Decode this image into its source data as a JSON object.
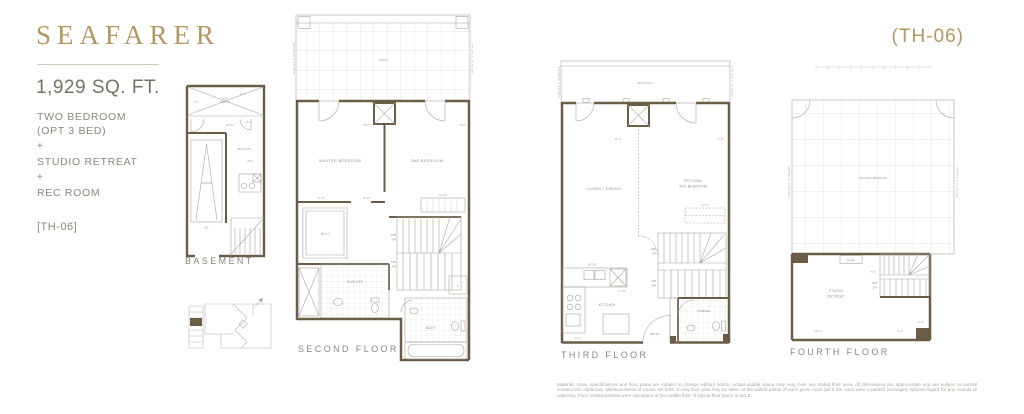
{
  "header": {
    "title": "SEAFARER",
    "area": "1,929 SQ. FT.",
    "features": [
      "TWO BEDROOM",
      "(OPT 3 BED)",
      "+",
      "STUDIO RETREAT",
      "+",
      "REC ROOM"
    ],
    "unit_code": "[TH-06]",
    "unit_code_top": "(TH-06)"
  },
  "labels": {
    "privacy_screen": "PRIVACY SCREEN",
    "patio": "PATIO",
    "balcony": "BALCONY",
    "private_terrace": "PRIVATE TERRACE"
  },
  "floors": {
    "basement": {
      "name": "BASEMENT",
      "rooms": {
        "low1": "LOW",
        "low2": "CEILING",
        "entry": "ENTRY",
        "rec_room": "REC ROOM",
        "garage": "GARAGE",
        "stairs_dn": "DN"
      },
      "dims": {
        "top": "17'-0\"",
        "left": "8'-0\"",
        "entry": "16'-0\"",
        "rec": "8'-9\""
      }
    },
    "second": {
      "name": "SECOND FLOOR",
      "rooms": {
        "master": "MASTER BEDROOM",
        "bed2": "2ND BEDROOM",
        "wic": "W.I.C.",
        "ensuite": "ENSUITE",
        "bath": "BATH",
        "linen": "L"
      },
      "stairs": {
        "up_r": "14R",
        "up": "UP",
        "dn_r": "14R",
        "dn": "DN"
      },
      "dims": {
        "master": "18'-7\"",
        "bed2": "9'-2\"",
        "wic": "14'-8\"",
        "hall": "8'-11\"",
        "closet": "12'-2\""
      }
    },
    "third": {
      "name": "THIRD FLOOR",
      "rooms": {
        "living": "LIVING / DINING",
        "opt1": "OPTIONAL",
        "opt2": "3RD BEDROOM",
        "kitchen": "KITCHEN",
        "entry": "ENTRY",
        "powder": "POWDER"
      },
      "stairs": {
        "up_r": "15R",
        "up": "UP",
        "dn_r": "14R",
        "dn": "DN"
      },
      "dims": {
        "living": "11'-6\"",
        "bed": "7'-8\"",
        "closet": "12'-2\"",
        "kitchen": "18'-10\"",
        "kitchen_b": "7'-10\"",
        "entry": "8'-2\""
      }
    },
    "fourth": {
      "name": "FOURTH FLOOR",
      "rooms": {
        "studio1": "STUDIO",
        "studio2": "RETREAT",
        "stor": "STOR."
      },
      "stairs": {
        "dn_r": "15R",
        "dn": "DN"
      },
      "dims": {
        "w": "12'-1\"",
        "d": "5'-4\"",
        "stair": "7'-5\"",
        "side": "9'-4\""
      }
    }
  },
  "disclaimer": "Material, sizes, specifications and floor plans are subject to change without notice. Actual usable space may vary from any stated floor area. All dimensions are approximate and are subject to normal construction variances. Measurements of rooms set forth on any floor plan may be taken at the widest points of each given room (as if the room were a perfect rectangle), without regard for any cutouts or cabinetry. Floor measurements were calculated at the middle floor of typical floor plans. E.&O.E.",
  "colors": {
    "gold": "#b4975f",
    "wall": "#6b5c46",
    "body_text": "#8d8779",
    "line": "#a8a59b"
  }
}
